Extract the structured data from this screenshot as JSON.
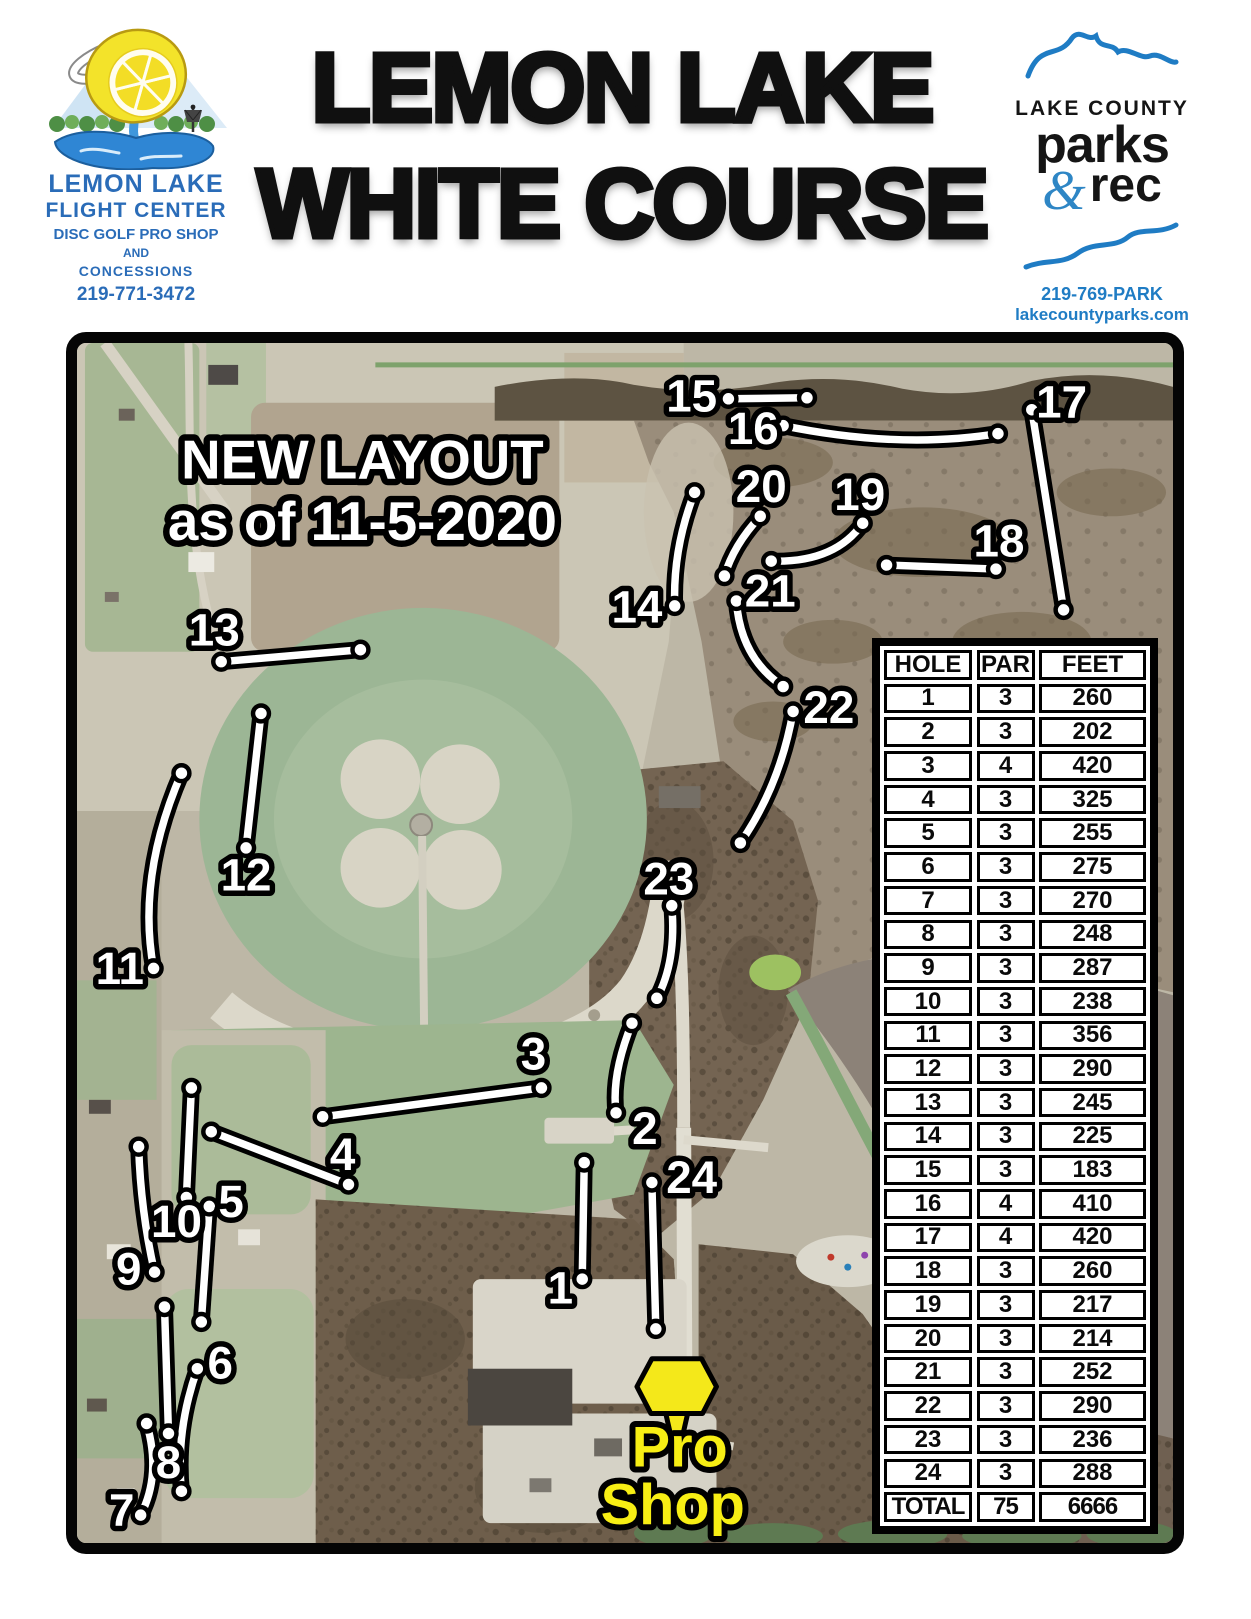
{
  "header": {
    "flight_center": {
      "name_line1": "LEMON LAKE",
      "name_line2": "FLIGHT CENTER",
      "subtitle_line1": "DISC GOLF PRO SHOP",
      "subtitle_line2": "AND",
      "subtitle_line3": "CONCESSIONS",
      "phone": "219-771-3472"
    },
    "title_line1": "LEMON LAKE",
    "title_line2": "WHITE COURSE",
    "parks_rec": {
      "county": "LAKE COUNTY",
      "parks": "parks",
      "ampersand": "&",
      "rec": "rec",
      "phone": "219-769-PARK",
      "website": "lakecountyparks.com"
    }
  },
  "map": {
    "notice_line1": "NEW LAYOUT",
    "notice_line2": "as of 11-5-2020",
    "pro_shop_line1": "Pro",
    "pro_shop_line2": "Shop",
    "holes": [
      {
        "n": "1",
        "x1": 510,
        "y1": 823,
        "x2": 508,
        "y2": 940,
        "lx": 486,
        "ly": 949
      },
      {
        "n": "2",
        "x1": 558,
        "y1": 683,
        "x2": 542,
        "y2": 773,
        "qx": 537,
        "qy": 735,
        "lx": 571,
        "ly": 789
      },
      {
        "n": "3",
        "x1": 247,
        "y1": 777,
        "x2": 467,
        "y2": 748,
        "lx": 459,
        "ly": 714
      },
      {
        "n": "4",
        "x1": 135,
        "y1": 792,
        "x2": 273,
        "y2": 845,
        "lx": 267,
        "ly": 815
      },
      {
        "n": "5",
        "x1": 133,
        "y1": 867,
        "x2": 125,
        "y2": 983,
        "lx": 155,
        "ly": 862
      },
      {
        "n": "6",
        "x1": 121,
        "y1": 1030,
        "x2": 105,
        "y2": 1153,
        "qx": 99,
        "qy": 1092,
        "lx": 144,
        "ly": 1024
      },
      {
        "n": "7",
        "x1": 70,
        "y1": 1085,
        "x2": 64,
        "y2": 1177,
        "qx": 85,
        "qy": 1136,
        "lx": 45,
        "ly": 1172
      },
      {
        "n": "8",
        "x1": 88,
        "y1": 968,
        "x2": 92,
        "y2": 1095,
        "lx": 92,
        "ly": 1124
      },
      {
        "n": "9",
        "x1": 62,
        "y1": 807,
        "x2": 78,
        "y2": 933,
        "qx": 64,
        "qy": 872,
        "lx": 52,
        "ly": 930
      },
      {
        "n": "10",
        "x1": 115,
        "y1": 748,
        "x2": 110,
        "y2": 858,
        "lx": 100,
        "ly": 882
      },
      {
        "n": "11",
        "x1": 105,
        "y1": 432,
        "x2": 77,
        "y2": 628,
        "qx": 60,
        "qy": 536,
        "lx": 43,
        "ly": 628
      },
      {
        "n": "12",
        "x1": 185,
        "y1": 372,
        "x2": 170,
        "y2": 507,
        "lx": 170,
        "ly": 534
      },
      {
        "n": "13",
        "x1": 145,
        "y1": 320,
        "x2": 285,
        "y2": 308,
        "lx": 138,
        "ly": 288
      },
      {
        "n": "14",
        "x1": 621,
        "y1": 150,
        "x2": 601,
        "y2": 264,
        "qx": 599,
        "qy": 206,
        "lx": 563,
        "ly": 265
      },
      {
        "n": "15",
        "x1": 655,
        "y1": 56,
        "x2": 734,
        "y2": 55,
        "lx": 618,
        "ly": 53
      },
      {
        "n": "16",
        "x1": 710,
        "y1": 83,
        "x2": 926,
        "y2": 91,
        "qx": 828,
        "qy": 107,
        "lx": 680,
        "ly": 86
      },
      {
        "n": "17",
        "x1": 960,
        "y1": 67,
        "x2": 992,
        "y2": 268,
        "lx": 990,
        "ly": 59
      },
      {
        "n": "18",
        "x1": 814,
        "y1": 223,
        "x2": 924,
        "y2": 227,
        "lx": 927,
        "ly": 199
      },
      {
        "n": "19",
        "x1": 790,
        "y1": 181,
        "x2": 698,
        "y2": 219,
        "qx": 762,
        "qy": 221,
        "lx": 787,
        "ly": 152
      },
      {
        "n": "20",
        "x1": 687,
        "y1": 174,
        "x2": 651,
        "y2": 234,
        "qx": 660,
        "qy": 203,
        "lx": 688,
        "ly": 144
      },
      {
        "n": "21",
        "x1": 663,
        "y1": 259,
        "x2": 710,
        "y2": 345,
        "qx": 667,
        "qy": 316,
        "lx": 697,
        "ly": 249
      },
      {
        "n": "22",
        "x1": 720,
        "y1": 370,
        "x2": 667,
        "y2": 502,
        "qx": 707,
        "qy": 444,
        "lx": 756,
        "ly": 366
      },
      {
        "n": "23",
        "x1": 598,
        "y1": 565,
        "x2": 583,
        "y2": 658,
        "qx": 603,
        "qy": 621,
        "lx": 595,
        "ly": 538
      },
      {
        "n": "24",
        "x1": 578,
        "y1": 843,
        "x2": 582,
        "y2": 990,
        "lx": 618,
        "ly": 838
      }
    ]
  },
  "score_table": {
    "headers": [
      "HOLE",
      "PAR",
      "FEET"
    ],
    "rows": [
      [
        "1",
        "3",
        "260"
      ],
      [
        "2",
        "3",
        "202"
      ],
      [
        "3",
        "4",
        "420"
      ],
      [
        "4",
        "3",
        "325"
      ],
      [
        "5",
        "3",
        "255"
      ],
      [
        "6",
        "3",
        "275"
      ],
      [
        "7",
        "3",
        "270"
      ],
      [
        "8",
        "3",
        "248"
      ],
      [
        "9",
        "3",
        "287"
      ],
      [
        "10",
        "3",
        "238"
      ],
      [
        "11",
        "3",
        "356"
      ],
      [
        "12",
        "3",
        "290"
      ],
      [
        "13",
        "3",
        "245"
      ],
      [
        "14",
        "3",
        "225"
      ],
      [
        "15",
        "3",
        "183"
      ],
      [
        "16",
        "4",
        "410"
      ],
      [
        "17",
        "4",
        "420"
      ],
      [
        "18",
        "3",
        "260"
      ],
      [
        "19",
        "3",
        "217"
      ],
      [
        "20",
        "3",
        "214"
      ],
      [
        "21",
        "3",
        "252"
      ],
      [
        "22",
        "3",
        "290"
      ],
      [
        "23",
        "3",
        "236"
      ],
      [
        "24",
        "3",
        "288"
      ]
    ],
    "total_row": [
      "TOTAL",
      "75",
      "6666"
    ]
  },
  "colors": {
    "logo_blue": "#2a6cb8",
    "parks_blue": "#1f7cc4",
    "label_yellow": "#f7ee14"
  }
}
